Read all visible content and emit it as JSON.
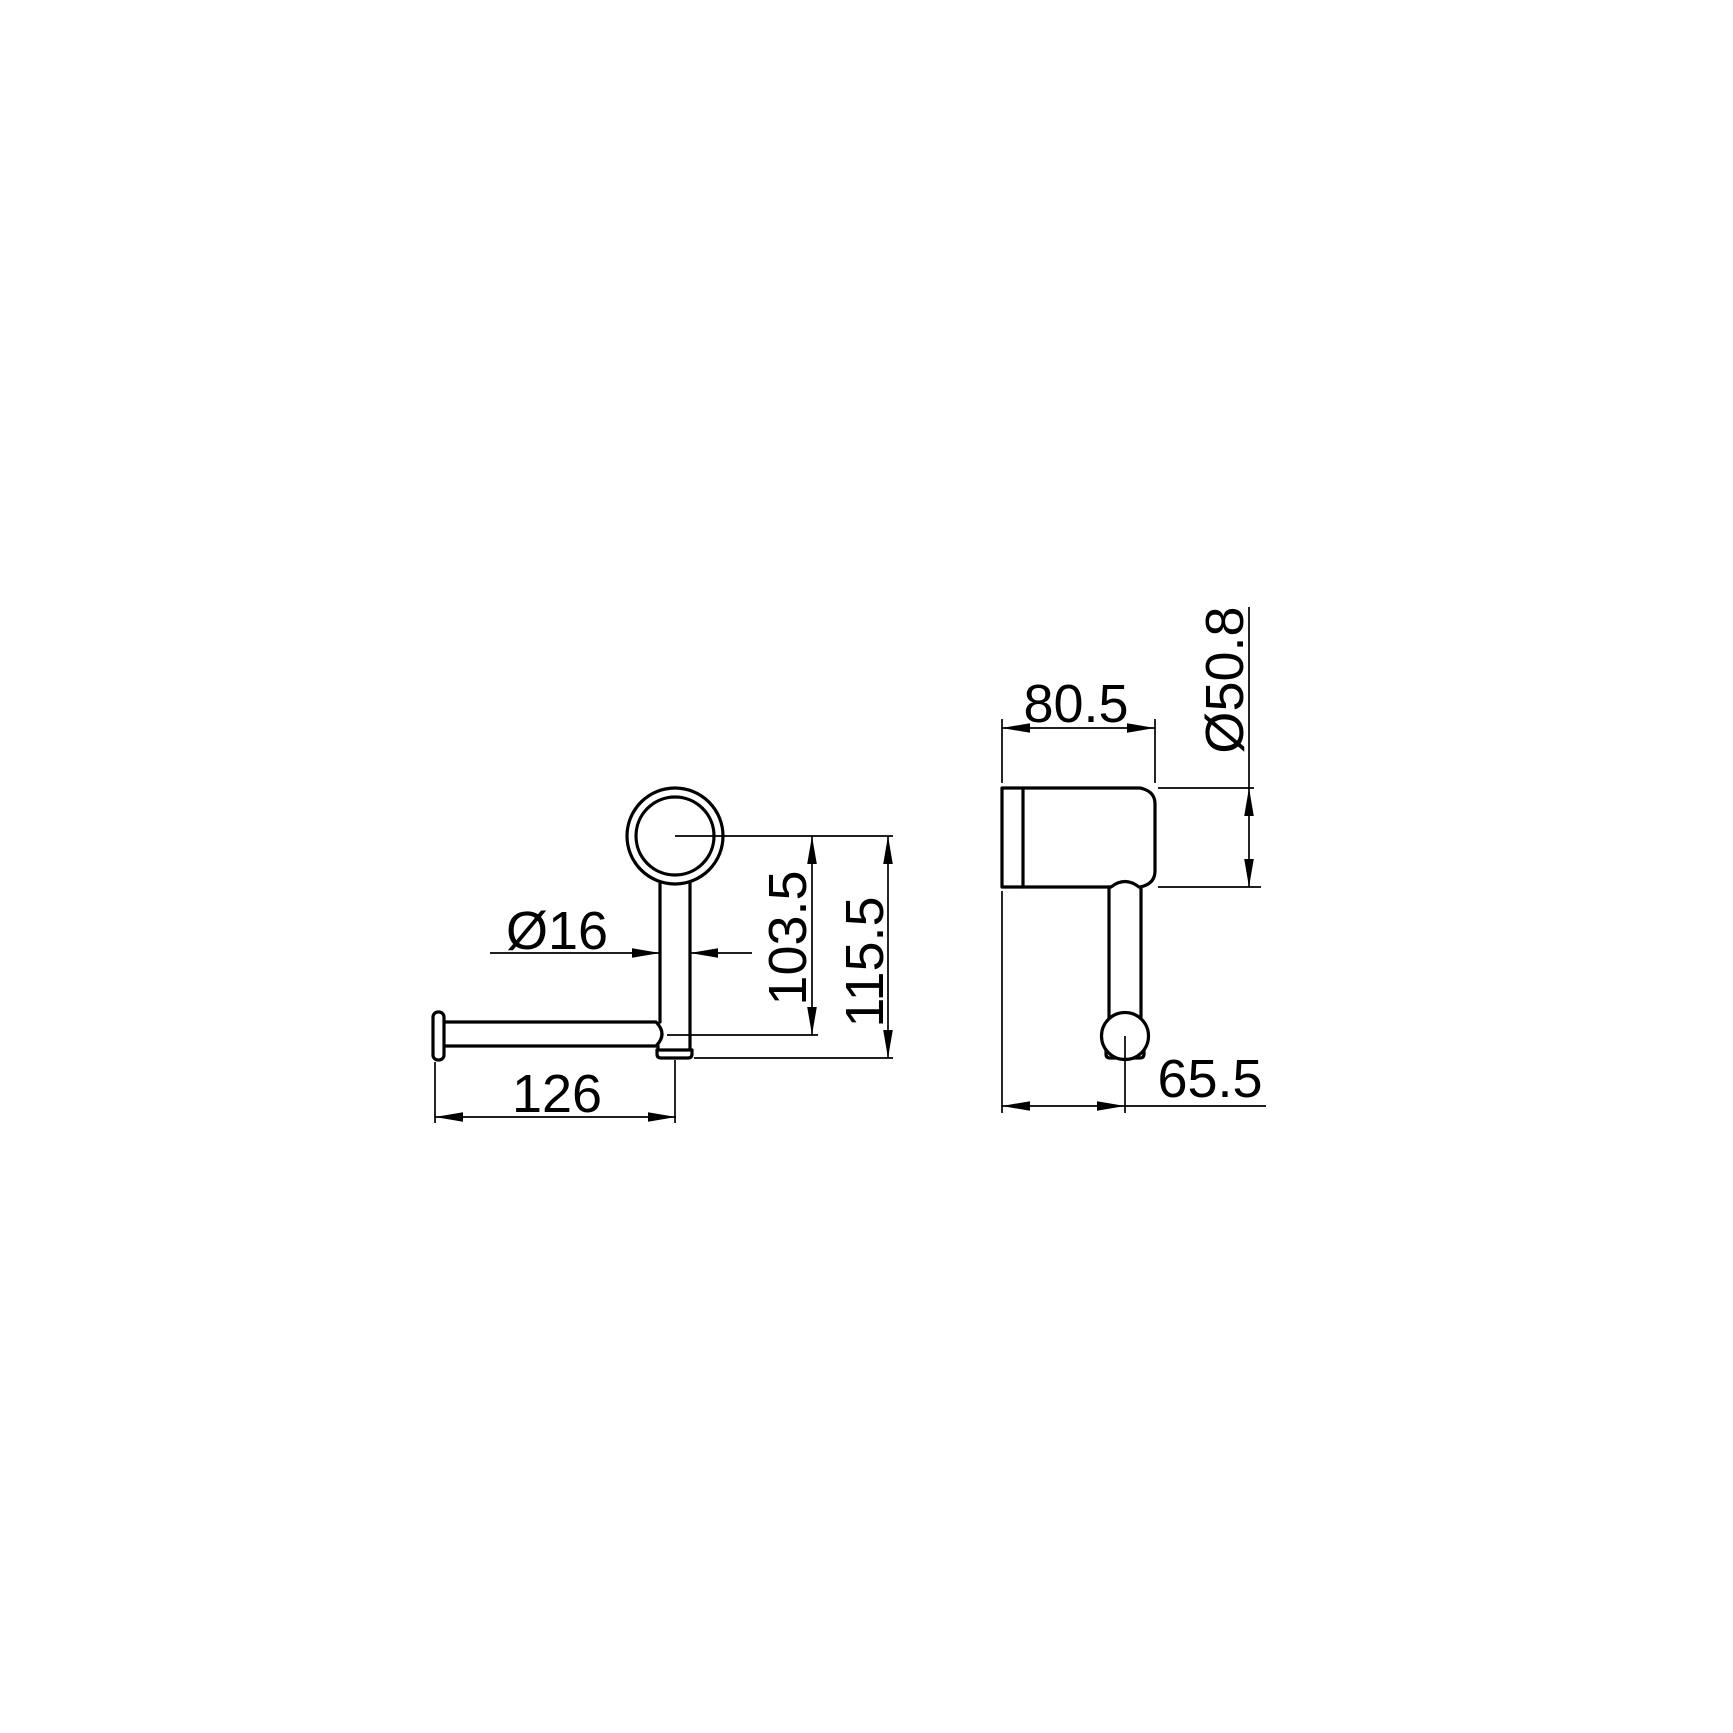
{
  "drawing": {
    "kind": "technical-dimension-drawing",
    "subject": "wall-mounted toilet roll holder, two orthographic views",
    "background_color": "#ffffff",
    "line_color": "#000000",
    "views": {
      "front": {
        "post_diameter": "Ø16",
        "center_to_bar": "103.5",
        "center_to_bottom": "115.5",
        "bar_length": "126"
      },
      "side": {
        "depth": "80.5",
        "plate_diameter": "Ø50.8",
        "wall_to_bar_axis": "65.5"
      }
    }
  }
}
